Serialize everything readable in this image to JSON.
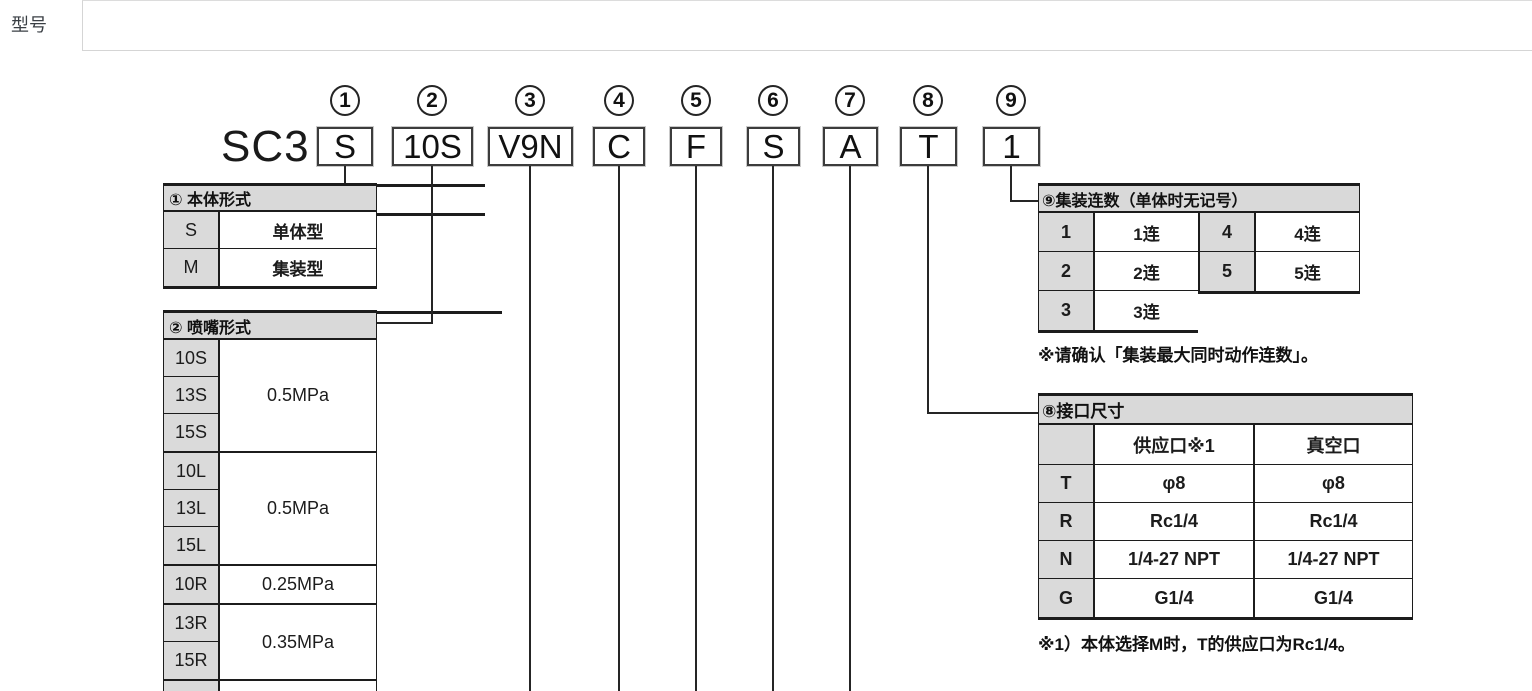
{
  "tabs": {
    "active_label": "型号",
    "items": [
      {
        "label": "维修零件"
      },
      {
        "label": "规格"
      }
    ]
  },
  "model": {
    "prefix": "SC3",
    "segments": [
      {
        "num": "1",
        "code": "S"
      },
      {
        "num": "2",
        "code": "10S"
      },
      {
        "num": "3",
        "code": "V9N"
      },
      {
        "num": "4",
        "code": "C"
      },
      {
        "num": "5",
        "code": "F"
      },
      {
        "num": "6",
        "code": "S"
      },
      {
        "num": "7",
        "code": "A"
      },
      {
        "num": "8",
        "code": "T"
      },
      {
        "num": "9",
        "code": "1"
      }
    ]
  },
  "table1": {
    "title": "① 本体形式",
    "rows": [
      {
        "code": "S",
        "label": "单体型"
      },
      {
        "code": "M",
        "label": "集装型"
      }
    ]
  },
  "table2": {
    "title": "② 喷嘴形式",
    "groups": [
      {
        "codes": [
          "10S",
          "13S",
          "15S"
        ],
        "value": "0.5MPa"
      },
      {
        "codes": [
          "10L",
          "13L",
          "15L"
        ],
        "value": "0.5MPa"
      },
      {
        "codes": [
          "10R"
        ],
        "value": "0.25MPa"
      },
      {
        "codes": [
          "13R",
          "15R"
        ],
        "value": "0.35MPa"
      }
    ]
  },
  "table9": {
    "title": "⑨集装连数（单体时无记号）",
    "left_rows": [
      {
        "code": "1",
        "label": "1连"
      },
      {
        "code": "2",
        "label": "2连"
      },
      {
        "code": "3",
        "label": "3连"
      }
    ],
    "right_rows": [
      {
        "code": "4",
        "label": "4连"
      },
      {
        "code": "5",
        "label": "5连"
      }
    ],
    "note": "※请确认「集装最大同时动作连数」。"
  },
  "table8": {
    "title": "⑧接口尺寸",
    "col_headers": [
      "供应口※1",
      "真空口"
    ],
    "rows": [
      {
        "code": "T",
        "supply": "φ8",
        "vacuum": "φ8"
      },
      {
        "code": "R",
        "supply": "Rc1/4",
        "vacuum": "Rc1/4"
      },
      {
        "code": "N",
        "supply": "1/4-27 NPT",
        "vacuum": "1/4-27 NPT"
      },
      {
        "code": "G",
        "supply": "G1/4",
        "vacuum": "G1/4"
      }
    ],
    "note": "※1）本体选择M时，T的供应口为Rc1/4。"
  },
  "colors": {
    "link_blue": "#4e7ca6",
    "table_gray": "#d9d9d9",
    "line_black": "#1c1c1c"
  }
}
